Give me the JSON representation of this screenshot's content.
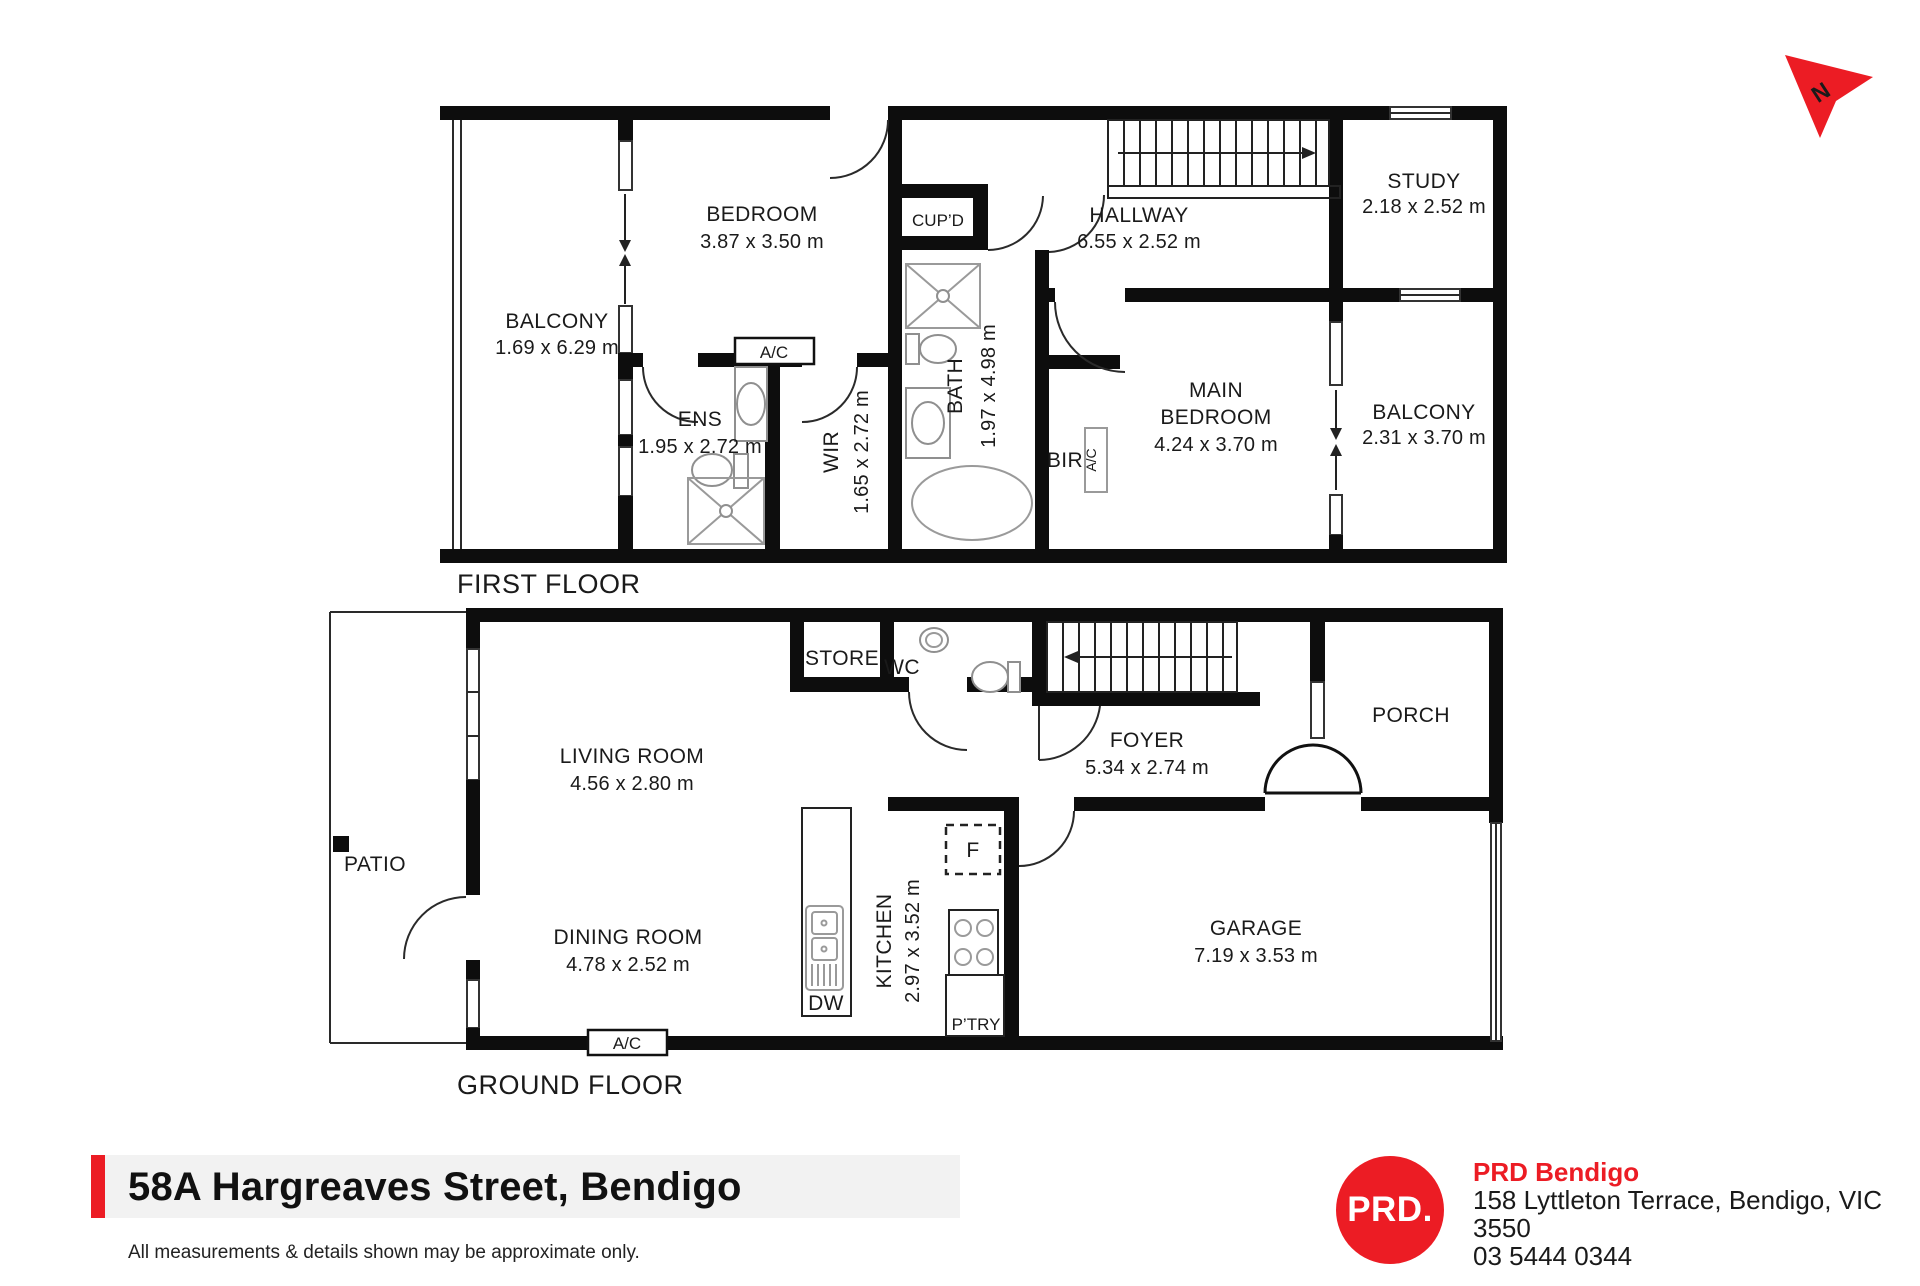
{
  "north_indicator": {
    "label": "N"
  },
  "first_floor": {
    "title": "FIRST FLOOR",
    "balcony_left": {
      "name": "BALCONY",
      "dims": "1.69 x 6.29 m"
    },
    "bedroom": {
      "name": "BEDROOM",
      "dims": "3.87 x 3.50 m"
    },
    "ens": {
      "name": "ENS",
      "dims": "1.95 x 2.72 m"
    },
    "ens_ac": {
      "name": "A/C"
    },
    "wir": {
      "name": "WIR",
      "dims": "1.65 x 2.72 m"
    },
    "cupboard": {
      "name": "CUP’D"
    },
    "bath": {
      "name": "BATH",
      "dims": "1.97 x 4.98 m"
    },
    "bir": {
      "name": "BIR"
    },
    "bir_ac": {
      "name": "A/C"
    },
    "hallway": {
      "name": "HALLWAY",
      "dims": "6.55 x 2.52 m"
    },
    "study": {
      "name": "STUDY",
      "dims": "2.18 x 2.52 m"
    },
    "main_bedroom": {
      "line1": "MAIN",
      "line2": "BEDROOM",
      "dims": "4.24 x 3.70 m"
    },
    "balcony_right": {
      "name": "BALCONY",
      "dims": "2.31 x 3.70 m"
    }
  },
  "ground_floor": {
    "title": "GROUND FLOOR",
    "patio": {
      "name": "PATIO"
    },
    "living_room": {
      "name": "LIVING ROOM",
      "dims": "4.56 x 2.80 m"
    },
    "dining_room": {
      "name": "DINING ROOM",
      "dims": "4.78 x 2.52 m"
    },
    "store": {
      "name": "STORE"
    },
    "wc": {
      "name": "WC"
    },
    "foyer": {
      "name": "FOYER",
      "dims": "5.34 x 2.74 m"
    },
    "porch": {
      "name": "PORCH"
    },
    "kitchen": {
      "name": "KITCHEN",
      "dims": "2.97 x 3.52 m"
    },
    "pantry": {
      "name": "P’TRY"
    },
    "fridge": {
      "name": "F"
    },
    "dishwasher": {
      "name": "DW"
    },
    "garage": {
      "name": "GARAGE",
      "dims": "7.19 x 3.53 m"
    },
    "ac": {
      "name": "A/C"
    }
  },
  "footer": {
    "address": "58A Hargreaves Street, Bendigo",
    "disclaimer": "All measurements & details shown may be approximate only.",
    "accent_color": "#ec1c24"
  },
  "agency": {
    "logo_text": "PRD.",
    "name": "PRD Bendigo",
    "address_line": "158 Lyttleton Terrace, Bendigo, VIC 3550",
    "phone": "03 5444 0344"
  }
}
